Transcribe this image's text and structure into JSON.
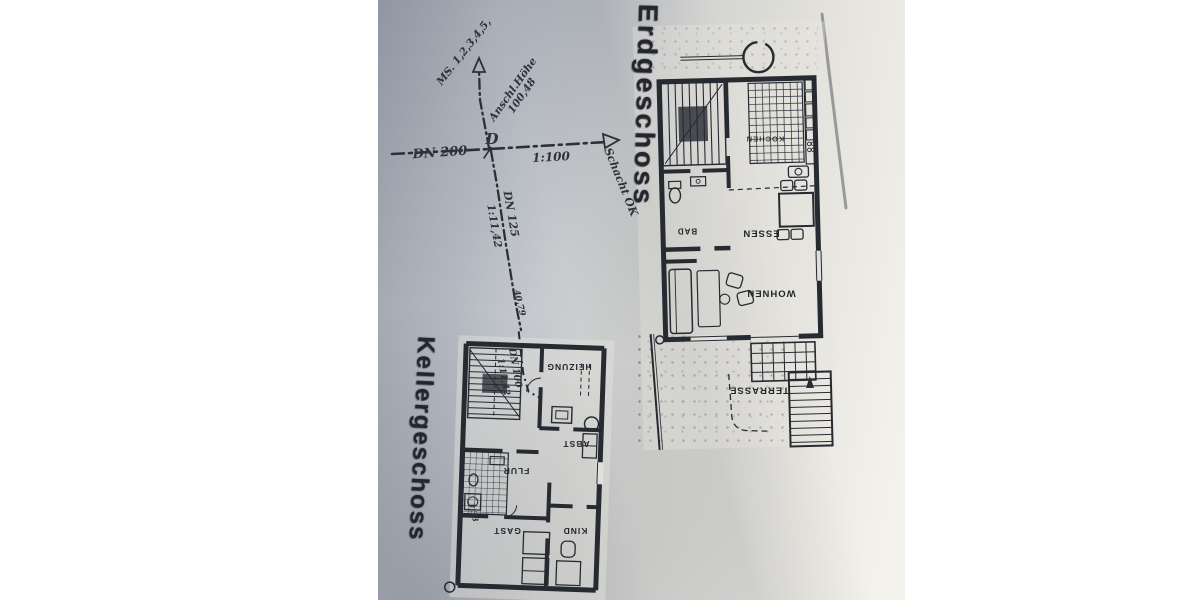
{
  "ground_floor": {
    "title": "Erdgeschoss",
    "room_labels": {
      "kitchen": "KOCHEN",
      "bath": "BAD",
      "dining": "ESSEN",
      "living": "WOHNEN",
      "terrace": "TERRASSE"
    }
  },
  "basement": {
    "title": "Kellergeschoss",
    "room_labels": {
      "heating": "HEIZUNG",
      "storage": "ABST",
      "hall": "FLUR",
      "guest": "GAST",
      "child": "KIND"
    },
    "pipe": {
      "diameter": "DN 100",
      "slope": "1:11,42"
    },
    "dimension_note": "1,33"
  },
  "drainage": {
    "main_line_diameter": "DN 200",
    "main_line_scale": "1:100",
    "junction_label": "D",
    "manhole_note": "MS. 1,2,3,4,5,",
    "connection_height_label": "Anschl.Höhe",
    "connection_height_value": "100,48",
    "shaft_note": "Schacht OK",
    "branch_diameter": "DN 125",
    "branch_slope": "1:11,42",
    "height_note": "40,79"
  },
  "colors": {
    "ink": "#262a31",
    "photo_paper": "#dcdcd8",
    "page_background": "#ffffff"
  }
}
